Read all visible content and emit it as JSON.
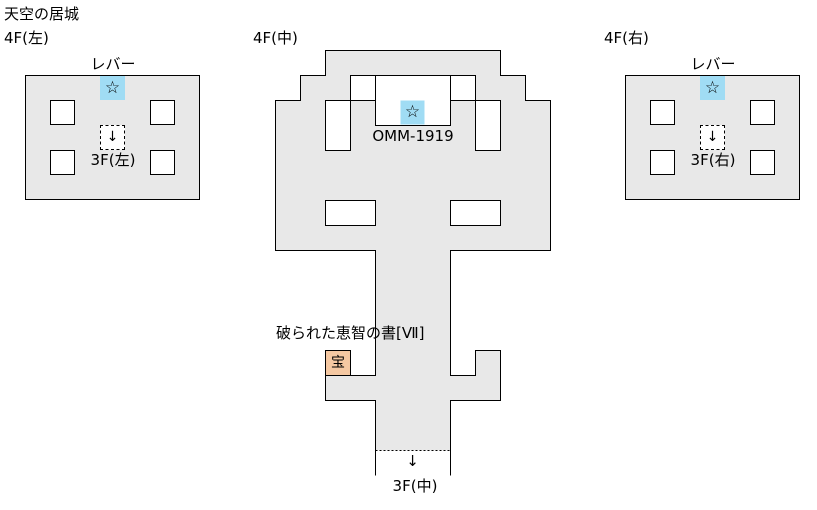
{
  "page": {
    "title": "天空の居城"
  },
  "colors": {
    "floor_fill": "#e8e8e8",
    "wall": "#000000",
    "lever_cell": "#a0dcf4",
    "treasure_cell": "#f5c8a2",
    "background": "#ffffff"
  },
  "glyphs": {
    "star": "☆",
    "down_arrow": "↓"
  },
  "maps": {
    "left": {
      "floor_label": "4F(左)",
      "lever_label": "レバー",
      "stairs_label": "3F(左)"
    },
    "middle": {
      "floor_label": "4F(中)",
      "event_label": "OMM-1919",
      "treasure_item_label": "破られた恵智の書[Ⅶ]",
      "treasure_glyph": "宝",
      "stairs_label": "3F(中)"
    },
    "right": {
      "floor_label": "4F(右)",
      "lever_label": "レバー",
      "stairs_label": "3F(右)"
    }
  }
}
